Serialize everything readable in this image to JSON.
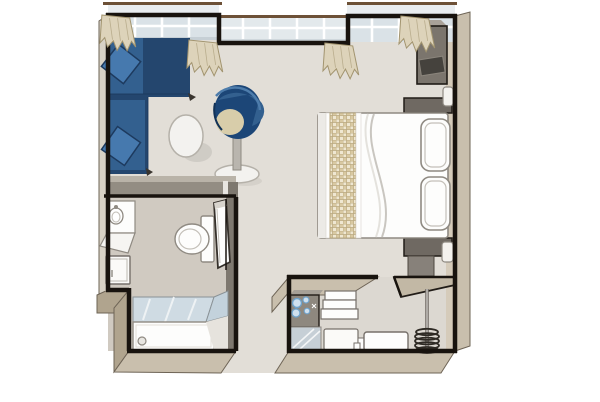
{
  "meta": {
    "description": "cruise-cabin-floor-plan"
  },
  "rooms": {
    "living": "living-area",
    "sleeping": "sleeping-area",
    "bathroom": "bathroom",
    "shower": "shower",
    "entrance": "entrance-hall",
    "wardrobe": "wardrobe-closet"
  },
  "furniture": [
    "l-shaped-sofa",
    "round-side-table",
    "tub-chair",
    "double-bed",
    "bed-runner",
    "pillow",
    "nightstand",
    "tv-cabinet",
    "wall-tv",
    "light-switch",
    "sink-vanity",
    "vanity-cabinet",
    "toilet",
    "bathroom-door",
    "shower-glass",
    "shower-tray",
    "minibar-counter",
    "mirror-panel",
    "shelf-unit",
    "bench",
    "closet-shelf",
    "clothes-rail-with-hangers",
    "window",
    "curtain"
  ],
  "palette": {
    "wall_line": "#18130e",
    "skirt": "#c9bfad",
    "skirt_dark": "#b0a48e",
    "skirt_light": "#d8d2c6",
    "skirt_edge": "#6e6456",
    "floor_main": "#e2ded7",
    "floor_bath": "#d0cac1",
    "floor_niche": "#dcd8d1",
    "wall_inner_tan": "#d5cbba",
    "band_grey": "#938d83",
    "band_grey_light": "#b9b3a8",
    "wall_grey": "#7e786f",
    "glass": "#dae2e7",
    "glass_outer": "#e9edf0",
    "glass_mid": "#e3e9ec",
    "mullion": "#ffffff",
    "rail_brown": "#6d5137",
    "curtain": "#ddd3ba",
    "curtain_edge": "#a2946f",
    "sofa_navy": "#24466e",
    "sofa_mid": "#33608f",
    "sofa_light": "#4679ae",
    "cushion_edge": "#1d3a5e",
    "chair_navy": "#1c4677",
    "chair_seat": "#d8cdaa",
    "chair_high": "#4d7cab",
    "table_fill": "#f3f2ef",
    "table_stroke": "#b5b1a9",
    "shadow": "#cbc7c0",
    "white": "#fdfdfc",
    "outline_grey": "#8f8a82",
    "outline_soft": "#c4c0b9",
    "furn_stroke": "#76706a",
    "runner": "#d9c9a2",
    "runner_light": "#efe7d2",
    "runner_line": "#b9a87f",
    "nightstand": "#6f6962",
    "unit_grey": "#87817a",
    "tv_cab": "#7b756d",
    "tv_cab_top": "#a9a299",
    "tv_screen": "#45423d",
    "switch": "#f4f2ee",
    "minibar": "#8e887f",
    "minibar_top": "#a6a097",
    "glass_blue_fill": "#cfe0ee",
    "glass_blue_stroke": "#6fa3cc",
    "mirror": "#c6cfd6",
    "shower_glass": "#cfdbe3",
    "shower_glass_dark": "#c3d2dc",
    "shower_glass_stroke": "#8a9296",
    "shelf_tan": "#c2b8a5",
    "coil": "#2e2a24",
    "black": "#211c17"
  }
}
